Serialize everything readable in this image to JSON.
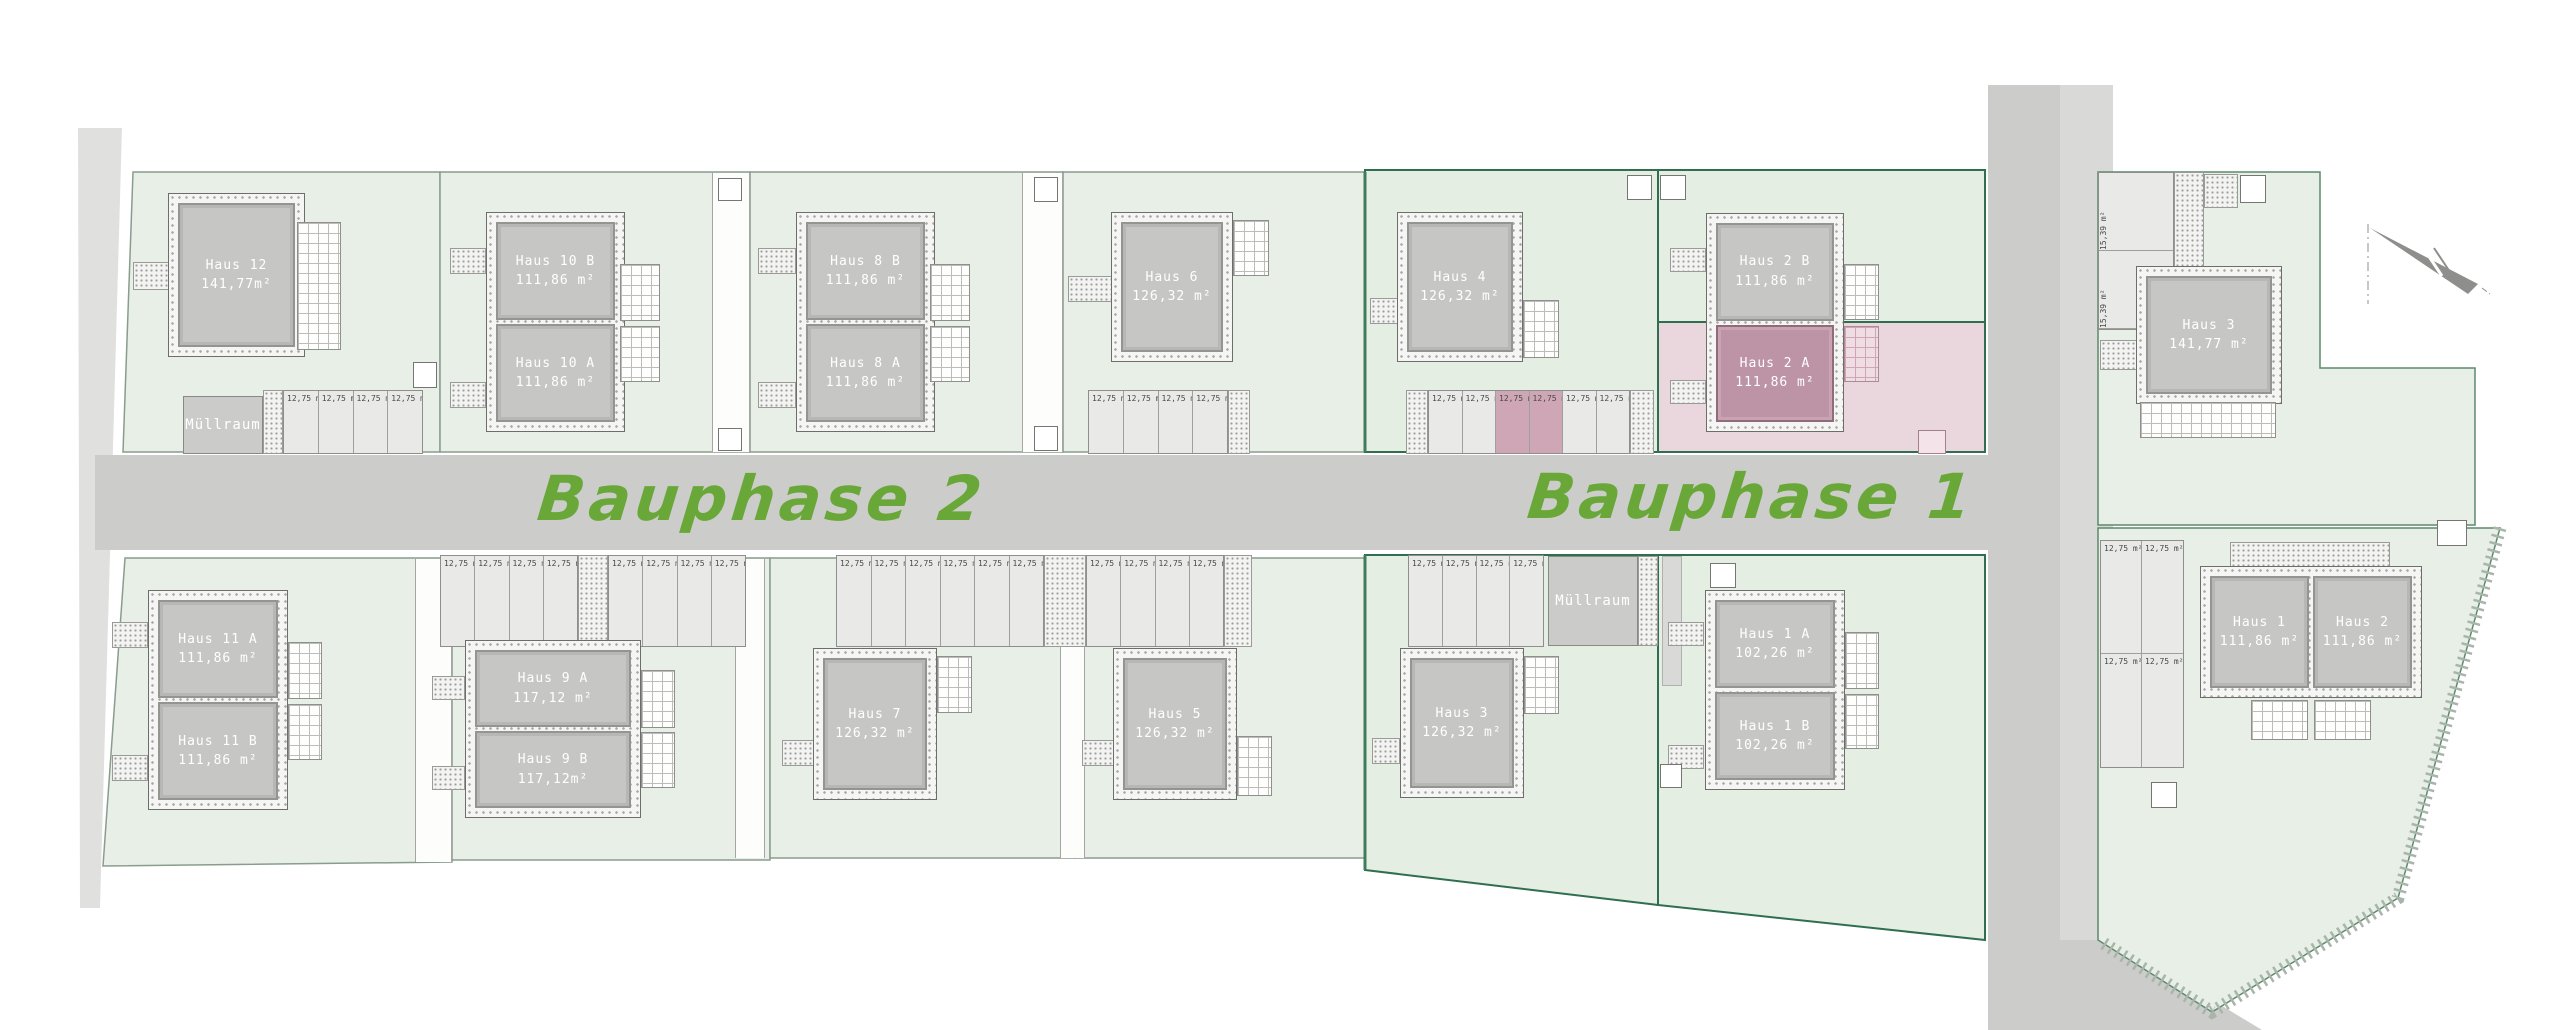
{
  "site": {
    "phase2_label": "Bauphase 2",
    "phase1_label": "Bauphase 1",
    "accent_green": "#69a838",
    "parcel_green": "#e7efe7",
    "highlight_pink": "#bd94a5",
    "garden_pink": "#ead7de"
  },
  "labels": {
    "stall": "12,75 m²",
    "garage": "15,39 m²",
    "muellraum": "Müllraum"
  },
  "houses": {
    "h12": {
      "name": "Haus 12",
      "area": "141,77m²"
    },
    "h10b": {
      "name": "Haus 10 B",
      "area": "111,86 m²"
    },
    "h10a": {
      "name": "Haus 10 A",
      "area": "111,86 m²"
    },
    "h8b": {
      "name": "Haus 8 B",
      "area": "111,86 m²"
    },
    "h8a": {
      "name": "Haus 8 A",
      "area": "111,86 m²"
    },
    "h6": {
      "name": "Haus 6",
      "area": "126,32 m²"
    },
    "h4": {
      "name": "Haus 4",
      "area": "126,32 m²"
    },
    "h2b": {
      "name": "Haus 2 B",
      "area": "111,86 m²"
    },
    "h2a": {
      "name": "Haus 2 A",
      "area": "111,86 m²"
    },
    "h11a": {
      "name": "Haus 11 A",
      "area": "111,86 m²"
    },
    "h11b": {
      "name": "Haus 11 B",
      "area": "111,86 m²"
    },
    "h9a": {
      "name": "Haus 9 A",
      "area": "117,12 m²"
    },
    "h9b": {
      "name": "Haus 9 B",
      "area": "117,12m²"
    },
    "h7": {
      "name": "Haus 7",
      "area": "126,32 m²"
    },
    "h5": {
      "name": "Haus 5",
      "area": "126,32 m²"
    },
    "h3": {
      "name": "Haus 3",
      "area": "126,32 m²"
    },
    "h1a": {
      "name": "Haus 1 A",
      "area": "102,26 m²"
    },
    "h1b": {
      "name": "Haus 1 B",
      "area": "102,26 m²"
    },
    "r3": {
      "name": "Haus 3",
      "area": "141,77 m²"
    },
    "r1": {
      "name": "Haus 1",
      "area": "111,86 m²"
    },
    "r2": {
      "name": "Haus 2",
      "area": "111,86 m²"
    }
  }
}
